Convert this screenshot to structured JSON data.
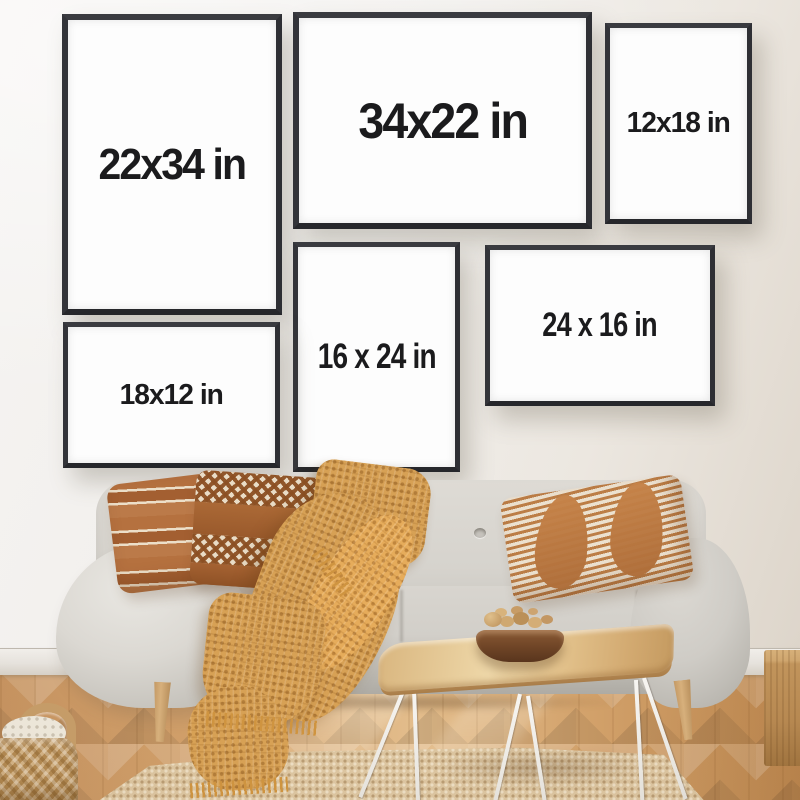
{
  "frames": [
    {
      "label": "22x34 in"
    },
    {
      "label": "34x22 in"
    },
    {
      "label": "12x18 in"
    },
    {
      "label": "16 x 24 in"
    },
    {
      "label": "24 x 16 in"
    },
    {
      "label": "18x12 in"
    }
  ],
  "colors": {
    "frame_border": "#333439",
    "frame_canvas": "#fdfdfd",
    "label_text": "#1b1b1d",
    "wall": "#f0edea",
    "baseboard": "#e6e2dc",
    "floor_wood": "#c8965e",
    "sofa_fabric": "#d5d2cc",
    "sofa_leg_wood": "#c59a63",
    "pillow_brown": "#b0713f",
    "pillow_cream": "#ecdfc9",
    "throw_blanket": "#d7a155",
    "rug_jute": "#dcc5a0",
    "basket": "#c79d63",
    "table_wood": "#e0c08b",
    "hairpin_legs": "#f5f3ef",
    "bowl_wood": "#6e4426",
    "cube_wood": "#b98a52"
  }
}
